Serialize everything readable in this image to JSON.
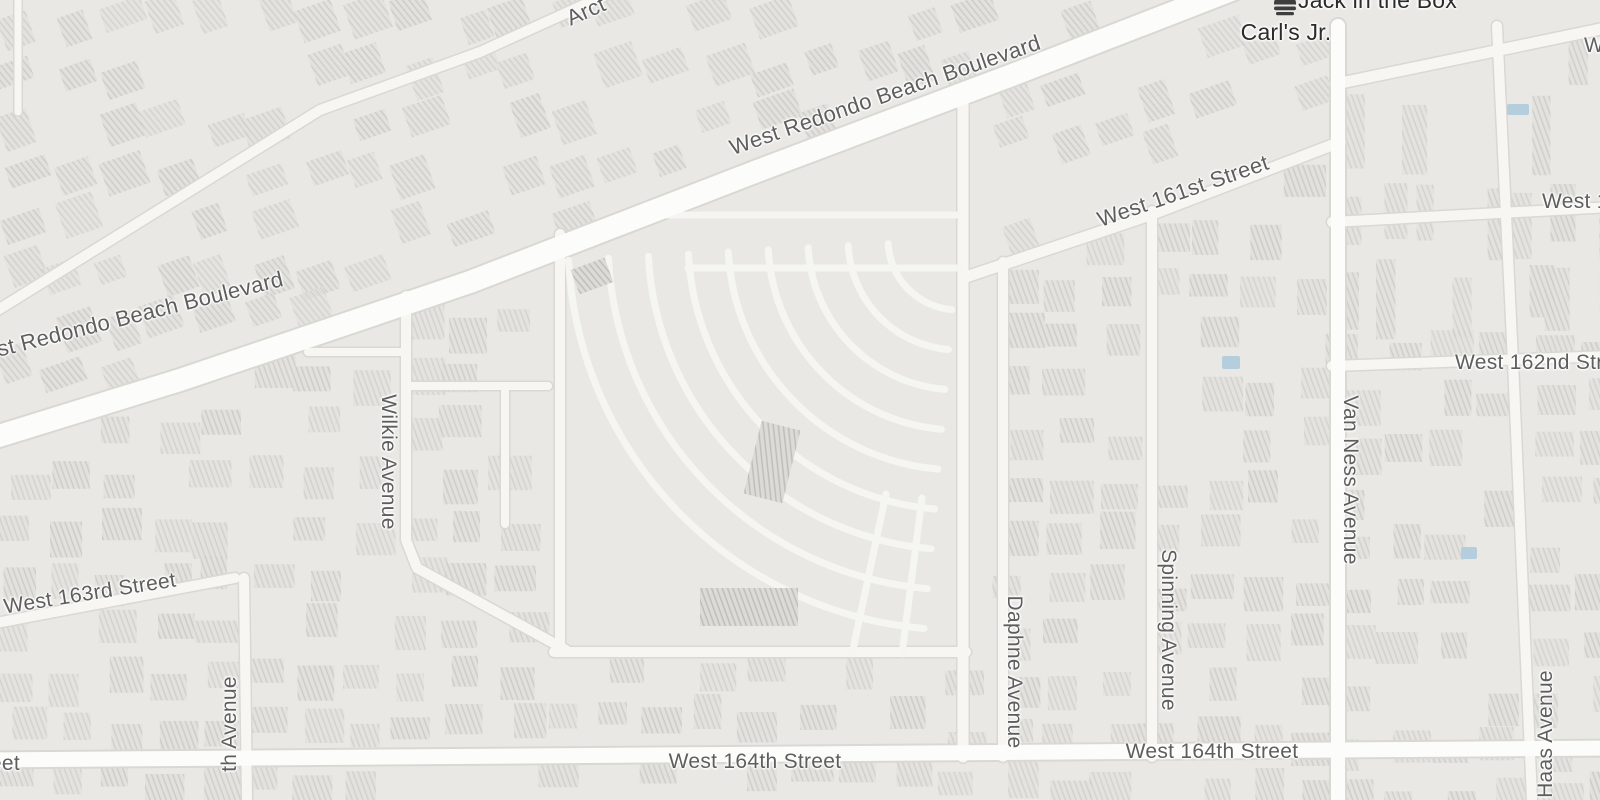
{
  "colors": {
    "background": "#e9e8e4",
    "building": "#e2e1dd",
    "building_stripe": "#cbcac6",
    "building_dark": "#dcdbd7",
    "building_dark_stripe": "#bdbcb8",
    "road_minor": "#f7f6f3",
    "road_major": "#fcfcfa",
    "lane": "#f5f5f2",
    "casing": "#d9d8d3",
    "label": "#5e5e5e",
    "poi_label": "#2b2b2b",
    "poi_icon": "#3e3e3e",
    "water": "#b5cede"
  },
  "pois": [
    {
      "name": "Jack in the Box",
      "icon": "burger-icon"
    },
    {
      "name": "Carl's Jr.",
      "icon": "burger-icon"
    }
  ],
  "streets": {
    "redondo_top": "West Redondo Beach Boulevard",
    "redondo_left": "West Redondo Beach Boulevard",
    "arct_partial": "Arct",
    "w161": "West 161st Street",
    "w161_east_partial": "West 1",
    "w_partial": "W",
    "w162": "West 162nd Street",
    "w163": "West 163rd Street",
    "wilkie": "Wilkie Avenue",
    "daphne": "Daphne Avenue",
    "spinning": "Spinning Avenue",
    "van_ness": "Van Ness Avenue",
    "haas": "Haas Avenue",
    "avenue_partial": "th Avenue",
    "w164_a": "West 164th Street",
    "w164_b": "West 164th Street",
    "w164_left_clipped": "West 164th Street"
  }
}
